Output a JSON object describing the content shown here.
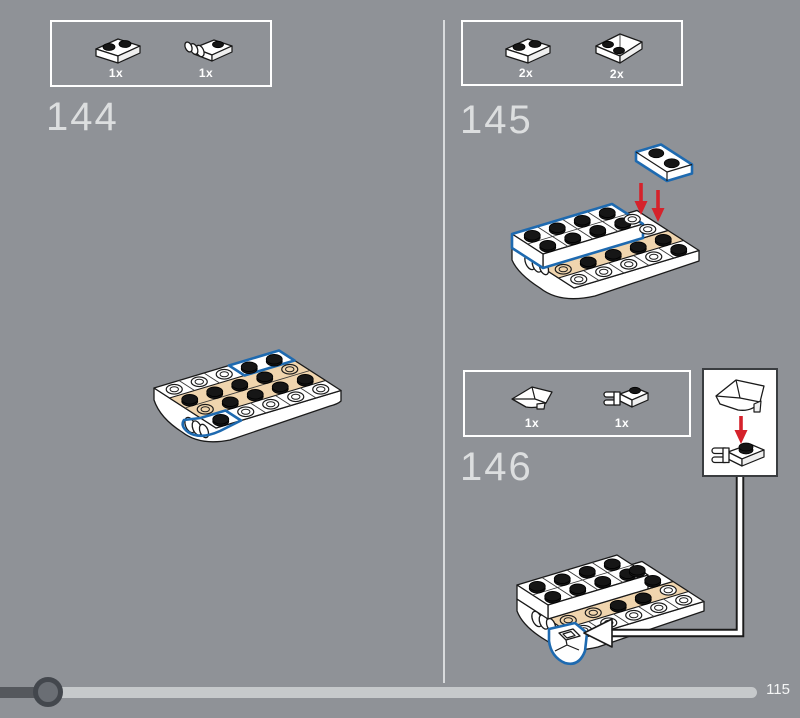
{
  "page": {
    "type": "lego-building-instructions",
    "page_label": "115"
  },
  "colors": {
    "background": "#8F9297",
    "highlight_blue": "#1E6AB0",
    "arrow_red": "#D5222B",
    "tan_plate": "#F0D5AE",
    "progress_track": "#C6C9CB",
    "progress_fill": "#55585D"
  },
  "steps": {
    "s144": {
      "number": "144",
      "parts": [
        {
          "icon": "plate-1x2-white",
          "qty": "1x"
        },
        {
          "icon": "plate-1x2-with-barrel-white",
          "qty": "1x"
        }
      ]
    },
    "s145": {
      "number": "145",
      "parts": [
        {
          "icon": "plate-1x2-white",
          "qty": "2x"
        },
        {
          "icon": "wedge-plate-2x2-white",
          "qty": "2x"
        }
      ]
    },
    "s146": {
      "number": "146",
      "parts": [
        {
          "icon": "wedge-slope-white",
          "qty": "1x"
        },
        {
          "icon": "plate-1x1-with-clip-white",
          "qty": "1x"
        }
      ]
    }
  },
  "progress": {
    "page_label": "115"
  }
}
